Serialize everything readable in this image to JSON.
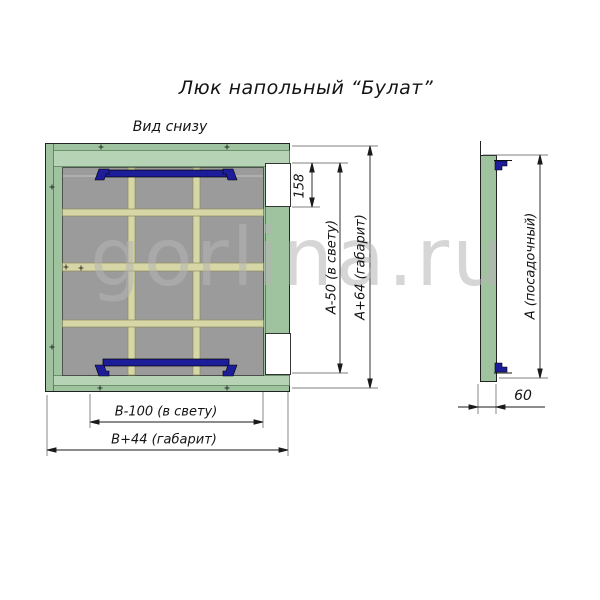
{
  "title": "Люк напольный “Булат”",
  "main_view": {
    "label": "Вид снизу",
    "dims": {
      "cutout_height": "158",
      "clear_height": "А-50 (в свету)",
      "overall_height": "А+64 (габарит)",
      "clear_width": "В-100 (в свету)",
      "overall_width": "В+44 (габарит)"
    }
  },
  "side_view": {
    "dims": {
      "seating_height": "А (посадочный)",
      "depth": "60"
    }
  },
  "watermark": "gorlina.ru",
  "colors": {
    "frame_green": "#9fc29f",
    "frame_band_green": "#b6d3b6",
    "frame_line_green": "#5e815e",
    "panel_gray": "#9b9b9b",
    "stiffener_khaki": "#d6d6a6",
    "hinge_navy": "#1d1d99"
  }
}
